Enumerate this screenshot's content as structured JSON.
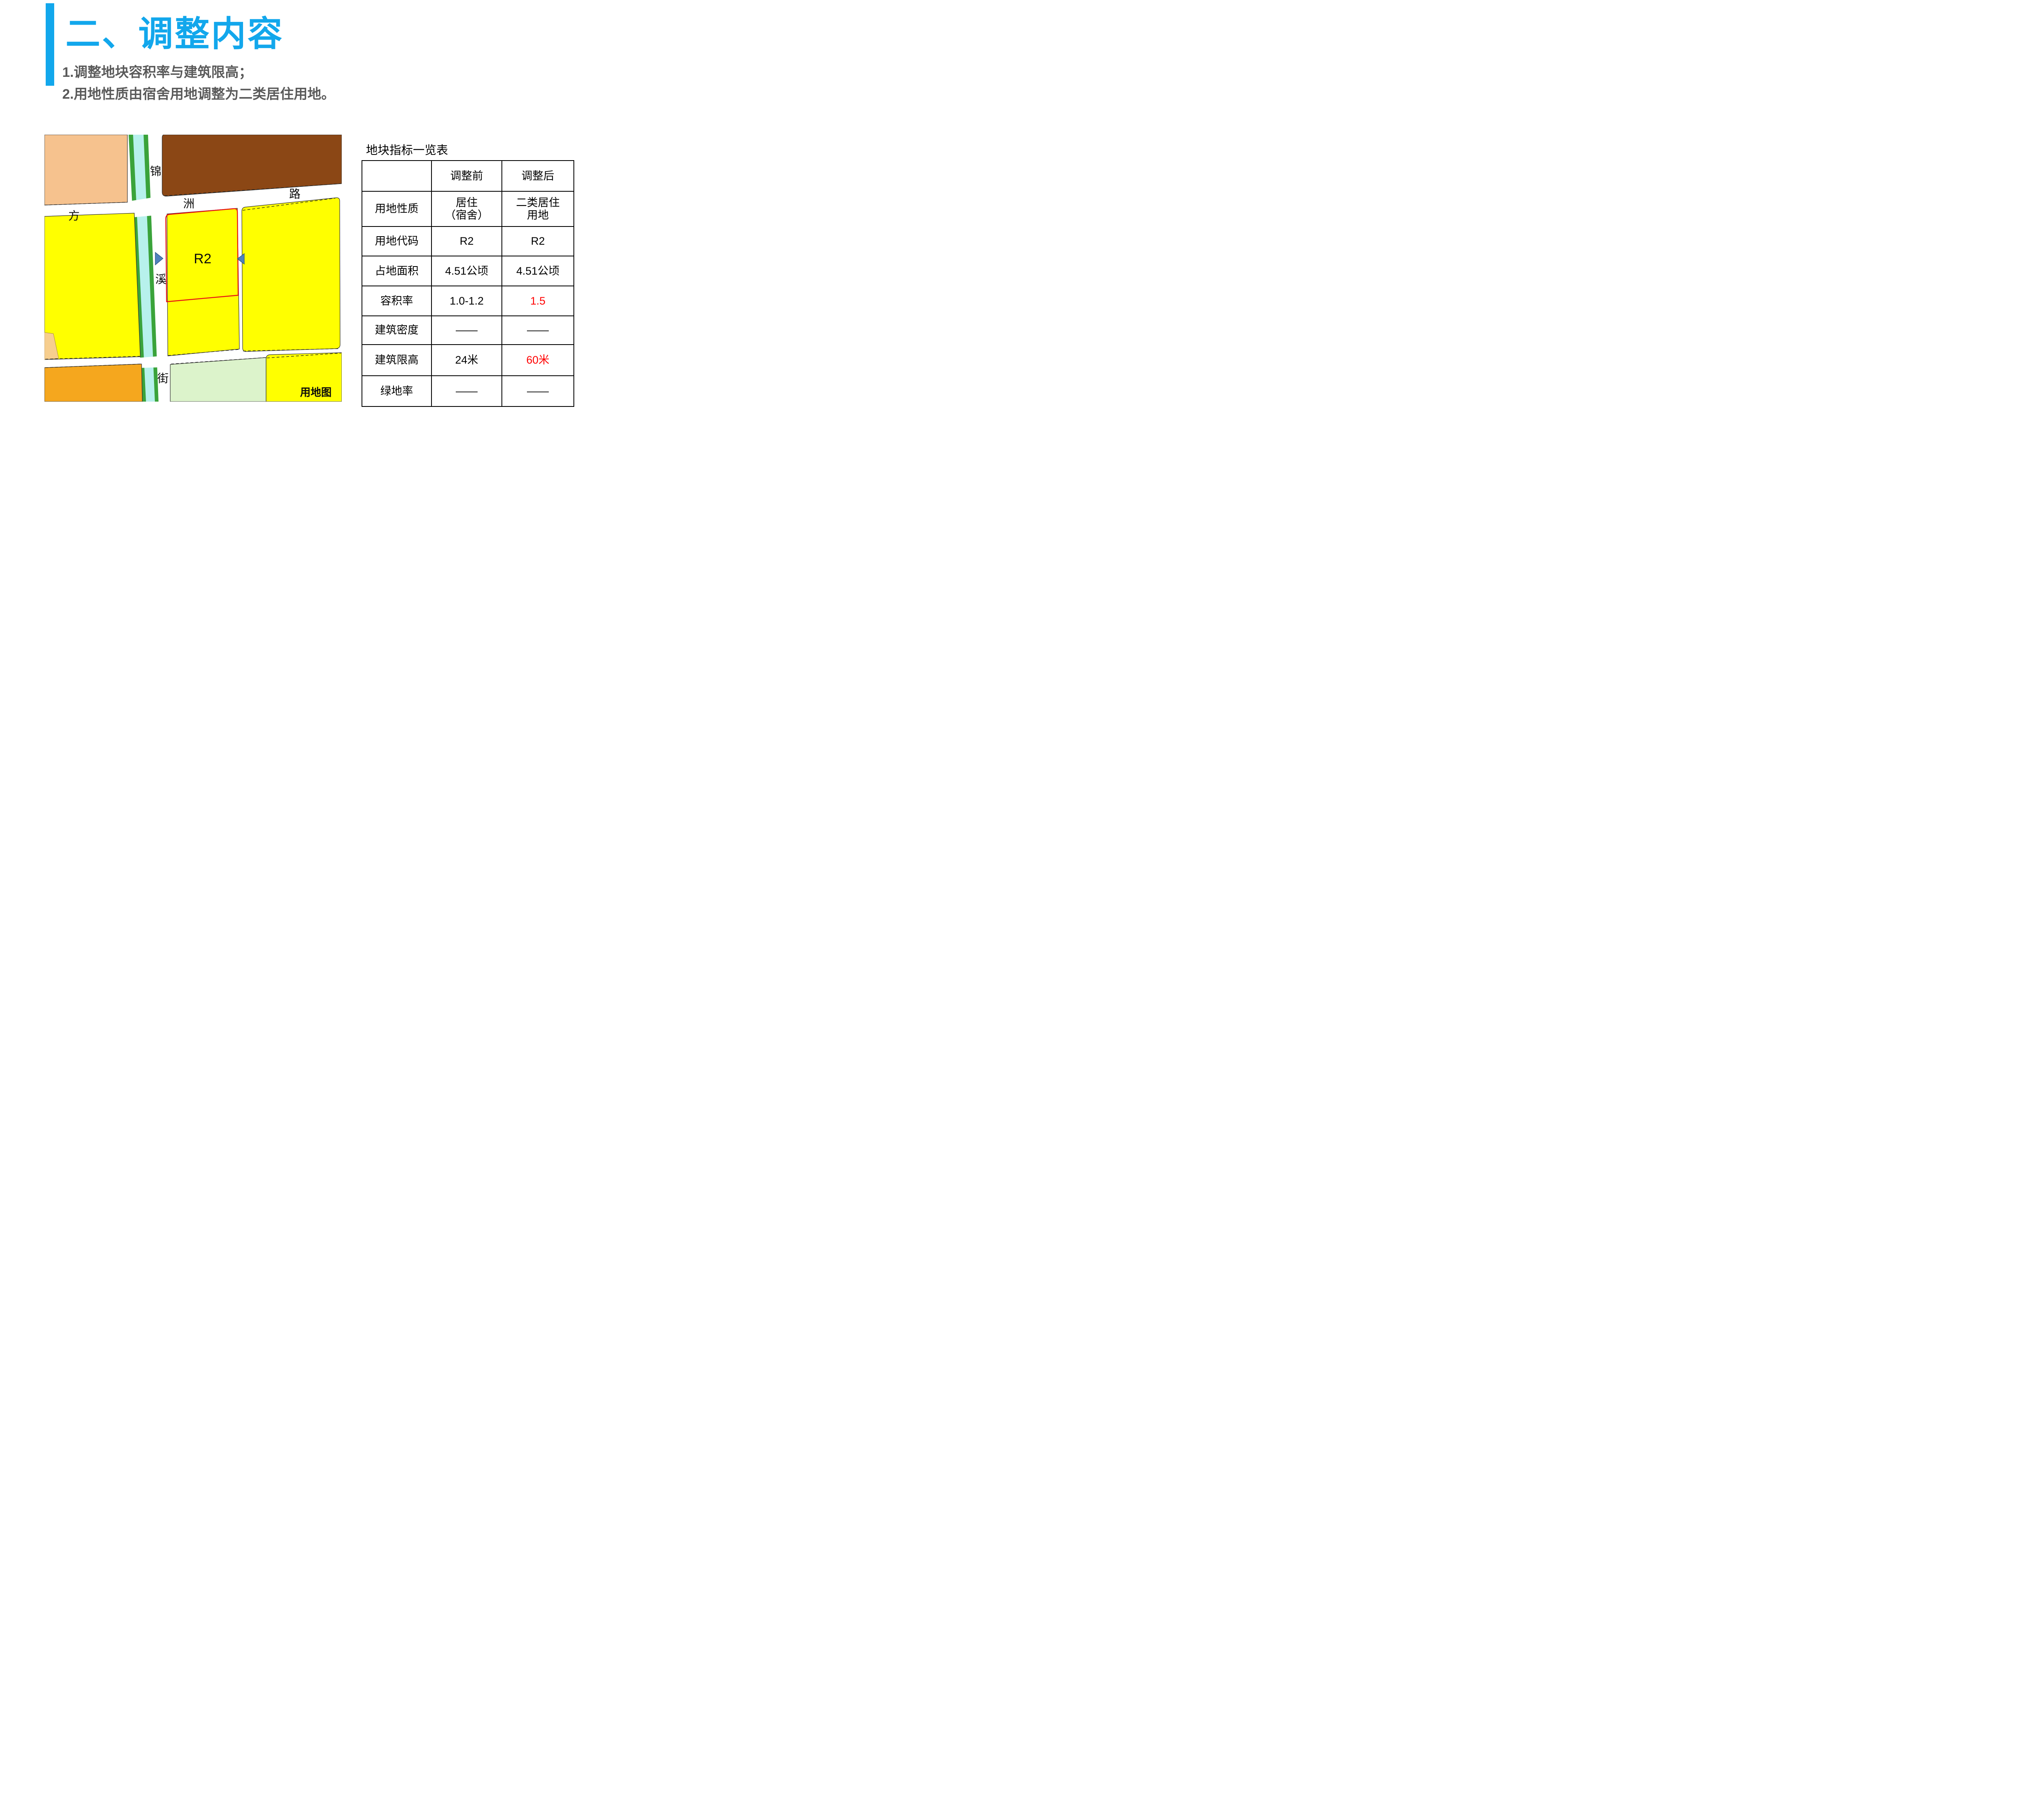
{
  "slide": {
    "section_title": "二、调整内容",
    "bullet1": "1.调整地块容积率与建筑限高；",
    "bullet2": "2.用地性质由宿舍用地调整为二类居住用地。",
    "accent_color": "#12A7EC",
    "bullet_color": "#595959"
  },
  "map": {
    "caption": "用地图",
    "parcel_code": "R2",
    "roads": {
      "horizontal": [
        "方",
        "洲",
        "路"
      ],
      "vertical": [
        "锦",
        "溪",
        "街"
      ]
    },
    "colors": {
      "residential_yellow": "#FFFF00",
      "peach_parcel": "#F6C28E",
      "tan_parcel": "#F7CE8E",
      "orange_parcel": "#F5A71E",
      "brown_parcel": "#8B4715",
      "green_space": "#DCF3CB",
      "stream_bank_green": "#3AA33A",
      "stream_water_cyan": "#B7F1EC",
      "boundary_red": "#E81414",
      "marker_blue": "#4F81BD"
    }
  },
  "table": {
    "title": "地块指标一览表",
    "columns": [
      "",
      "调整前",
      "调整后"
    ],
    "rows": [
      {
        "label": "用地性质",
        "before": "居住\n（宿舍）",
        "after": "二类居住\n用地",
        "after_highlight": false
      },
      {
        "label": "用地代码",
        "before": "R2",
        "after": "R2",
        "after_highlight": false
      },
      {
        "label": "占地面积",
        "before": "4.51公顷",
        "after": "4.51公顷",
        "after_highlight": false
      },
      {
        "label": "容积率",
        "before": "1.0-1.2",
        "after": "1.5",
        "after_highlight": true
      },
      {
        "label": "建筑密度",
        "before": "——",
        "after": "——",
        "after_highlight": false
      },
      {
        "label": "建筑限高",
        "before": "24米",
        "after": "60米",
        "after_highlight": true
      },
      {
        "label": "绿地率",
        "before": "——",
        "after": "——",
        "after_highlight": false
      }
    ],
    "highlight_color": "#FF0000"
  }
}
